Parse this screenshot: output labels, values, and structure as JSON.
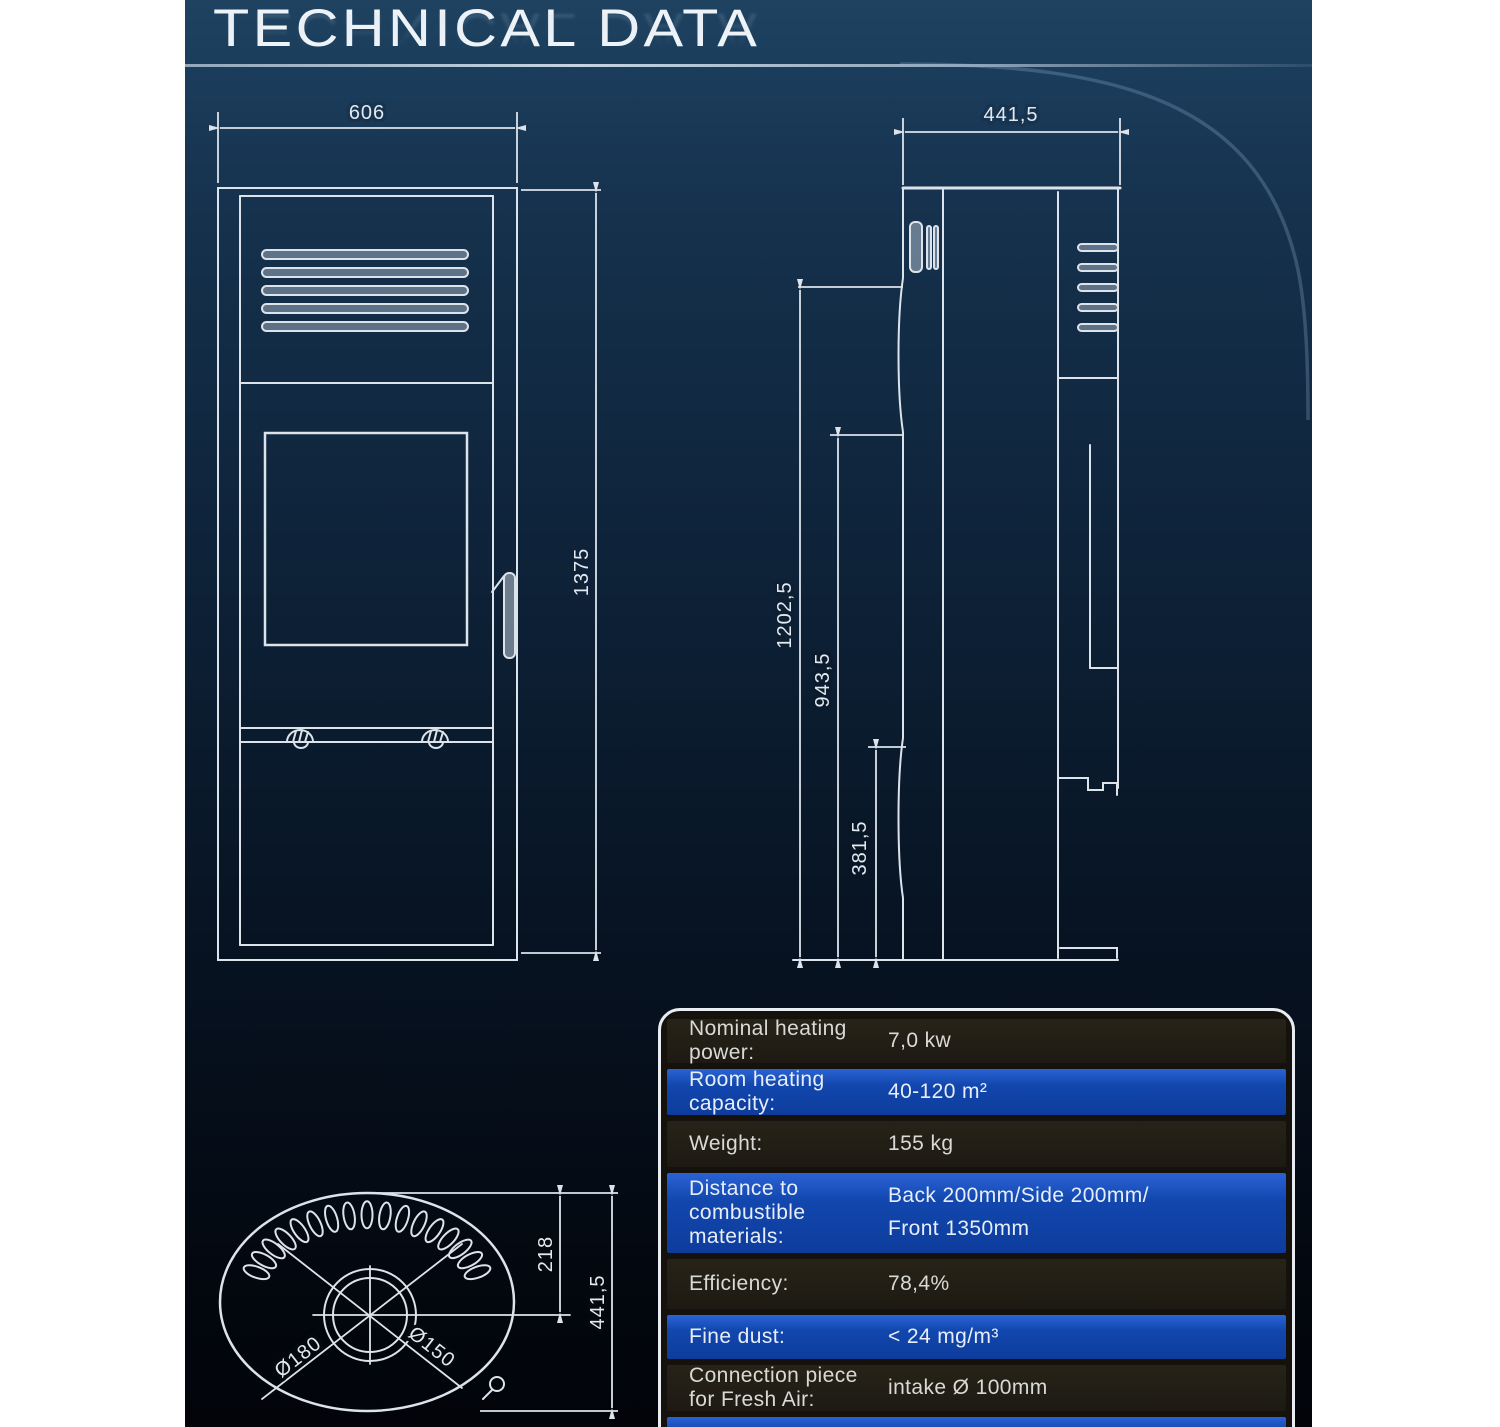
{
  "title": {
    "text": "TECHNICAL DATA"
  },
  "front_view": {
    "width": "606",
    "height": "1375"
  },
  "side_view": {
    "depth": "441,5",
    "flue_height": "1202,5",
    "mid_height": "943,5",
    "lower_height": "381,5"
  },
  "top_view": {
    "flue_offset": "218",
    "depth": "441,5",
    "outer_diameter": "Ø180",
    "inner_diameter": "Ø150"
  },
  "spec_table": {
    "rows": [
      {
        "label": "Nominal heating power:",
        "value": "7,0 kw"
      },
      {
        "label": "Room heating capacity:",
        "value": "40-120 m²"
      },
      {
        "label": "Weight:",
        "value": "155 kg"
      },
      {
        "label": "Distance to combustible materials:",
        "value": "Back 200mm/Side 200mm/",
        "value2": "Front 1350mm"
      },
      {
        "label": "Efficiency:",
        "value": "78,4%"
      },
      {
        "label": "Fine dust:",
        "value": "< 24 mg/m³"
      },
      {
        "label": "Connection piece for Fresh Air:",
        "value": "intake Ø 100mm"
      }
    ]
  },
  "colors": {
    "background_top": "#1b3d5c",
    "background_bottom": "#02050a",
    "line": "#dce3eb",
    "row_blue": "#1247ae",
    "row_dark": "#211d17",
    "table_border": "#e9edf1"
  }
}
